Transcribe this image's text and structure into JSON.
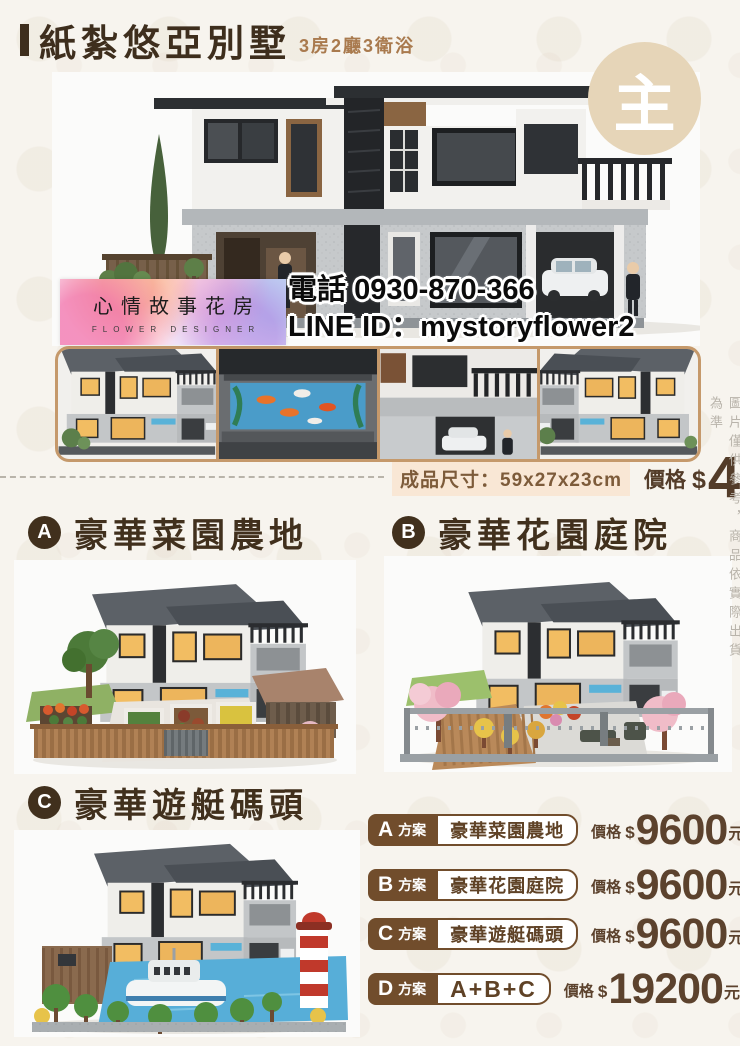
{
  "header": {
    "title": "紙紮悠亞別墅",
    "subtitle": "3房2廳3衛浴",
    "badge": "主"
  },
  "contact": {
    "phone_label": "電話",
    "phone": "0930-870-366",
    "line_label": "LINE ID：",
    "line_id": "mystoryflower2"
  },
  "logo": {
    "name": "心情故事花房",
    "tagline": "FLOWER DESIGNER"
  },
  "product": {
    "size_label": "成品尺寸：",
    "size": "59x27x23cm",
    "price_label": "價格",
    "currency": "$",
    "price": "4800",
    "unit": "元"
  },
  "sections": [
    {
      "letter": "A",
      "title": "豪華菜園農地"
    },
    {
      "letter": "B",
      "title": "豪華花園庭院"
    },
    {
      "letter": "C",
      "title": "豪華遊艇碼頭"
    }
  ],
  "plans_common": {
    "suffix": "方案",
    "price_label": "價格",
    "currency": "$",
    "unit": "元"
  },
  "plans": [
    {
      "letter": "A",
      "label": "豪華菜園農地",
      "price": "9600"
    },
    {
      "letter": "B",
      "label": "豪華花園庭院",
      "price": "9600"
    },
    {
      "letter": "C",
      "label": "豪華遊艇碼頭",
      "price": "9600"
    },
    {
      "letter": "D",
      "label": "A+B+C",
      "price": "19200"
    }
  ],
  "disclaimer": "圖片僅供參考，商品依實際出貨為準",
  "colors": {
    "background": "#f7f4ee",
    "title_brown": "#3e2e1d",
    "accent_brown": "#714d2c",
    "price_brown": "#5c422d",
    "tan_border": "#c5996b",
    "badge_circle": "#e6d5b8",
    "size_highlight": "#f9e7d5",
    "subtitle_brown": "#a97a4e"
  }
}
